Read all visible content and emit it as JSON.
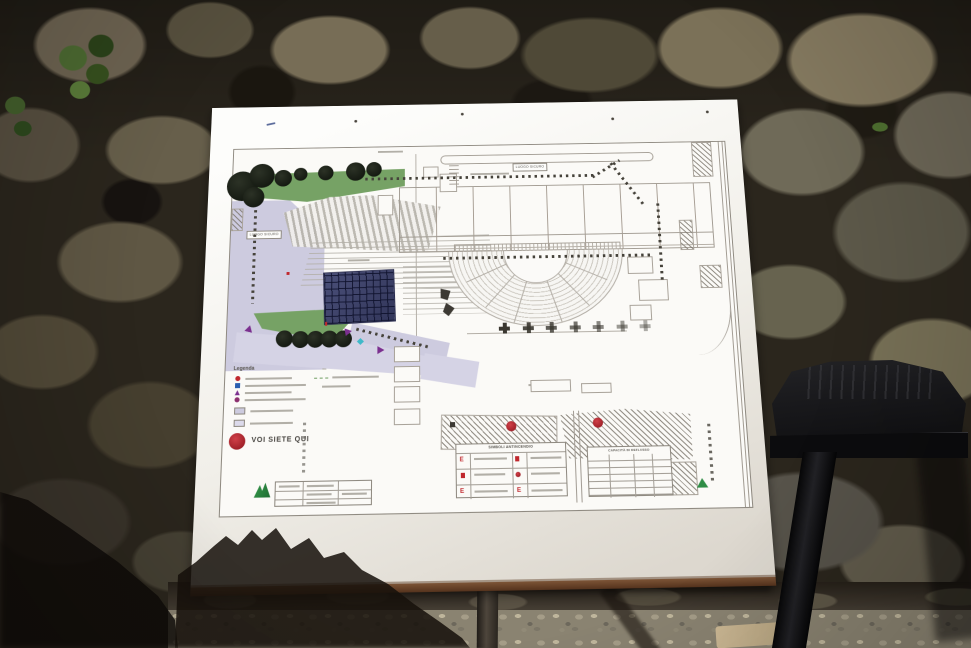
{
  "sign_map": {
    "legend_title": "Legenda",
    "you_are_here_label": "VOI SIETE QUI",
    "safe_area_label_top": "LUOGO SICURO",
    "safe_area_label_left": "LUOGO SICURO",
    "fire_table_title": "SIMBOLI ANTINCENDIO",
    "capacity_table_title": "CAPACITÀ DI DEFLUSSO",
    "exit_letters": [
      "E",
      "E",
      "E"
    ],
    "colors": {
      "you_are_here_red": "#bf2630",
      "safe_area_lavender": "#cdcbdf",
      "vegetation_green": "#76a265",
      "stage_grid_navy": "#3d4166",
      "plan_line_gray": "#9a958f",
      "logo_green": "#2f8d46"
    },
    "legend_symbols": [
      {
        "shape": "dot",
        "color": "#c0272d"
      },
      {
        "shape": "square",
        "color": "#2b5fb0"
      },
      {
        "shape": "triangle",
        "color": "#7b2f8f"
      },
      {
        "shape": "dot",
        "color": "#8c2f6e"
      }
    ],
    "legend_swatch_colors": [
      "#cdcbdf",
      "#dcdaeb"
    ],
    "counts": {
      "column_bases": 7,
      "trees_top_row": 8,
      "trees_bottom_row": 5
    }
  }
}
